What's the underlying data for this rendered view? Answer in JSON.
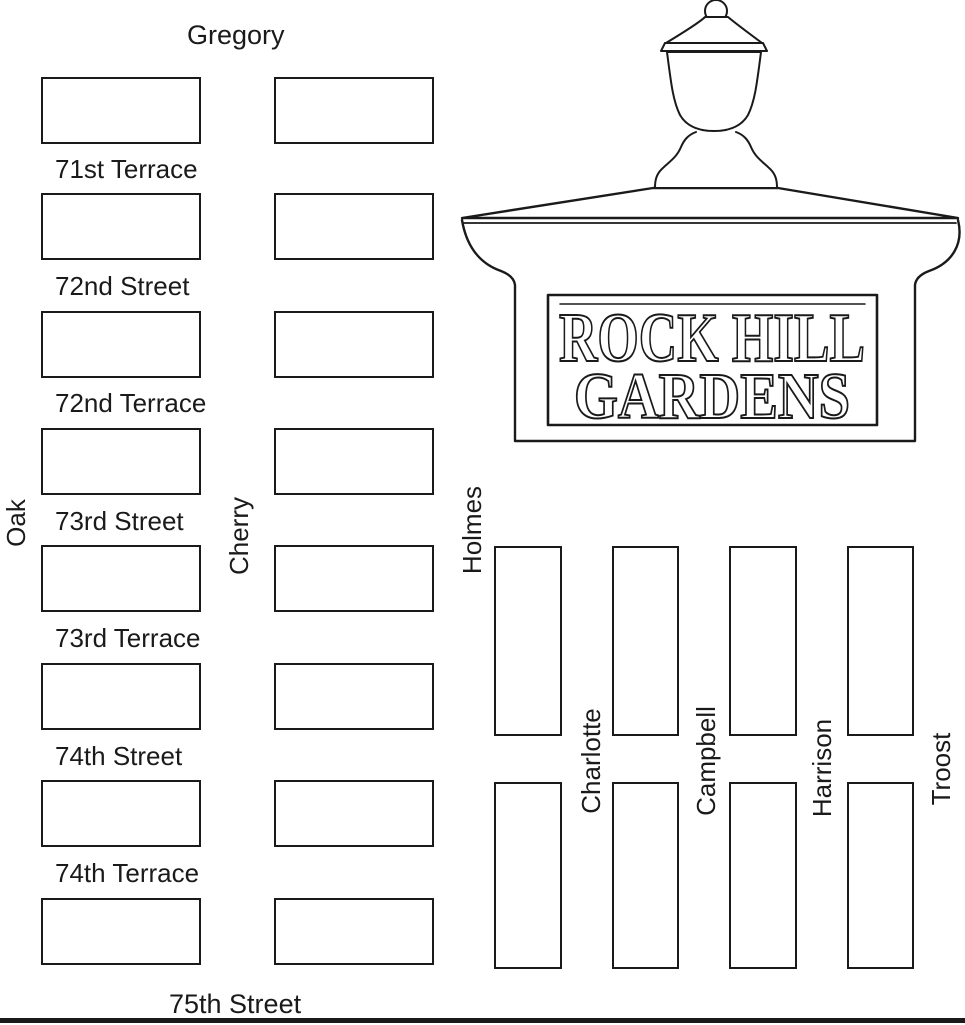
{
  "colors": {
    "ink": "#1a1a1a",
    "background": "#ffffff"
  },
  "map": {
    "horizontal_streets": {
      "top": "Gregory",
      "cross": [
        "71st Terrace",
        "72nd Street",
        "72nd Terrace",
        "73rd Street",
        "73rd Terrace",
        "74th Street",
        "74th Terrace"
      ],
      "bottom": "75th Street"
    },
    "vertical_streets": [
      "Oak",
      "Cherry",
      "Holmes",
      "Charlotte",
      "Campbell",
      "Harrison",
      "Troost"
    ]
  },
  "monument": {
    "sign": {
      "line1": "ROCK HILL",
      "line2": "GARDENS"
    }
  }
}
